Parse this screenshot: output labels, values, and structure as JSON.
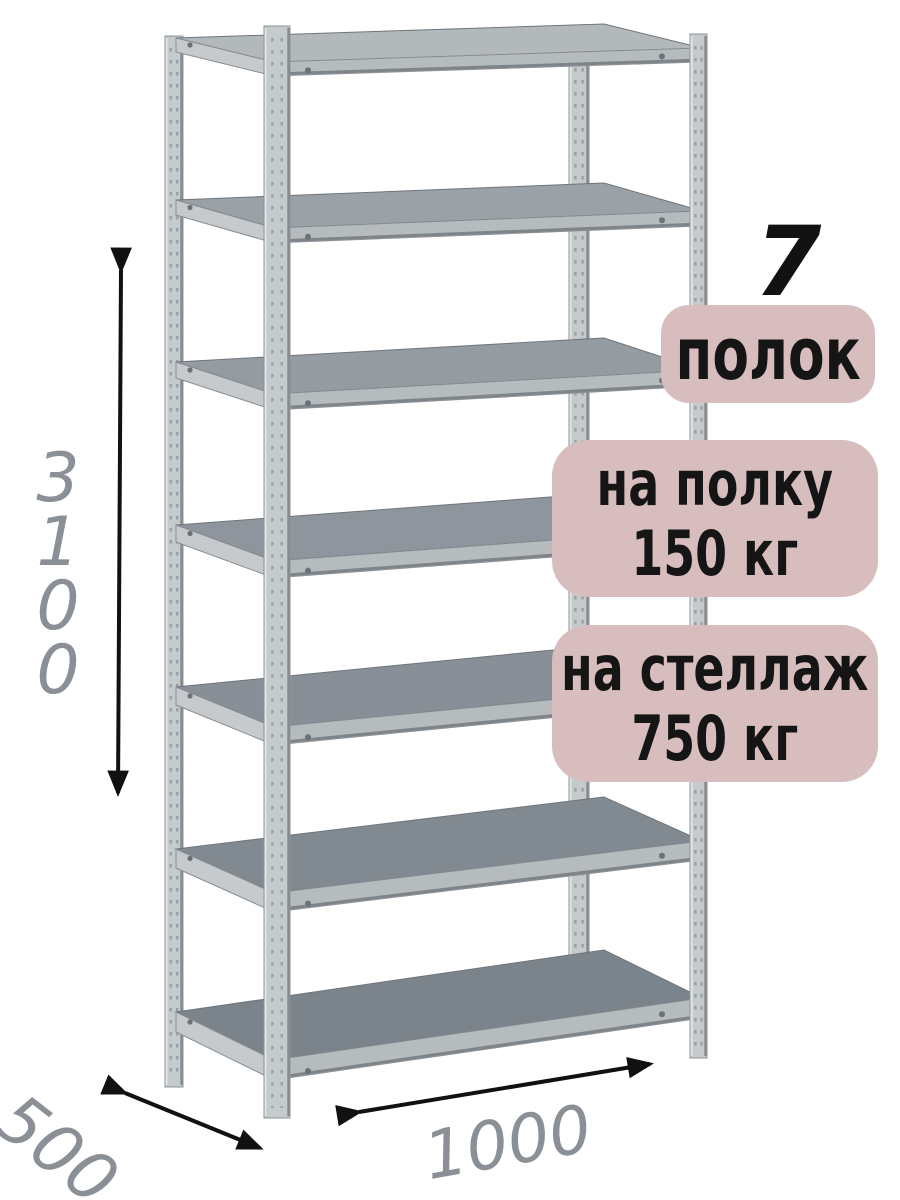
{
  "shelf_count_badge": {
    "number": "7",
    "label": "полок"
  },
  "load_badges": [
    {
      "line1": "на полку",
      "line2": "150 кг"
    },
    {
      "line1": "на стеллаж",
      "line2": "750 кг"
    }
  ],
  "dimensions": {
    "height": "3100",
    "depth": "500",
    "width": "1000"
  },
  "rack": {
    "shelf_count": 7,
    "post_count": 4
  },
  "colors": {
    "badge_bg": "#d7bdbd",
    "badge_text": "#151515",
    "dimension_text": "#8a9095",
    "arrow": "#111111",
    "metal_post": "#c5cacd",
    "metal_band": "#b6bbbe",
    "metal_shelf_dark": "#7b838b",
    "metal_shelf_light": "#b3b8bb"
  }
}
